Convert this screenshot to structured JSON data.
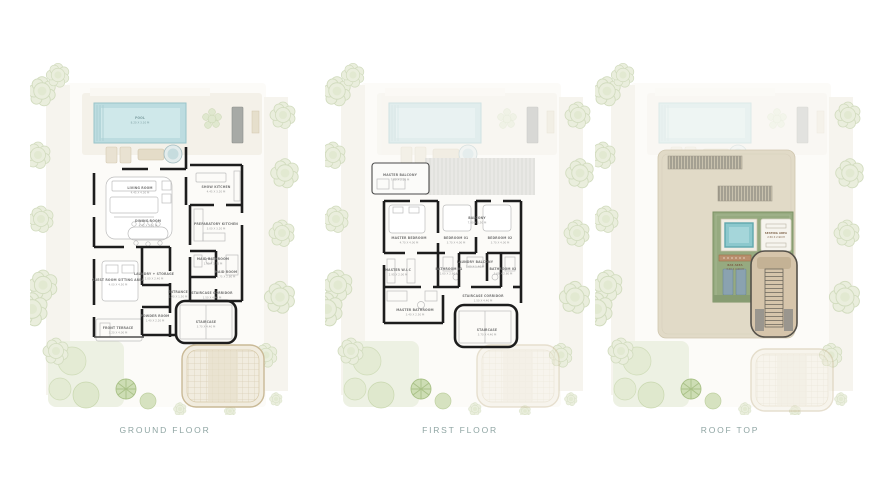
{
  "colors": {
    "caption_text": "#8FA5A3",
    "pool_water": "#BCDCE0",
    "walls": "#1D1D1D",
    "landscape_green": "#E9EEDA",
    "roof_slab_beige": "#E1DAC7",
    "roof_terrace_green": "#96AA80",
    "jacuzzi_blue": "#8CC8CD"
  },
  "plans": [
    {
      "caption": "GROUND FLOOR",
      "rooms": [
        {
          "n": "POOL",
          "d": "8.20 X 3.10 M"
        },
        {
          "n": "LIVING ROOM",
          "d": "4.45 X 4.30 M"
        },
        {
          "n": "SHOW KITCHEN",
          "d": "4.45 X 3.20 M"
        },
        {
          "n": "DINING ROOM",
          "d": "4.45 X 3.60 M"
        },
        {
          "n": "PREPARATORY KITCHEN",
          "d": "3.00 X 3.20 M"
        },
        {
          "n": "MAID BATHROOM",
          "d": "1.60 X 1.75 M"
        },
        {
          "n": "MAID ROOM",
          "d": "1.75 X 2.80 M"
        },
        {
          "n": "GUEST ROOM SITTING AREA",
          "d": "4.00 X 4.50 M"
        },
        {
          "n": "LAUNDRY + STORAGE",
          "d": "2.00 X 2.40 M"
        },
        {
          "n": "ENTRANCE",
          "d": "2.40 X 1.50 M"
        },
        {
          "n": "STAIRCASE CORRIDOR",
          "d": "1.50 X 4.40 M"
        },
        {
          "n": "POWDER ROOM",
          "d": "1.40 X 2.20 M"
        },
        {
          "n": "FRONT TERRACE",
          "d": "3.20 X 4.00 M"
        },
        {
          "n": "STAIRCASE",
          "d": "3.70 X 4.40 M"
        }
      ]
    },
    {
      "caption": "FIRST FLOOR",
      "rooms": [
        {
          "n": "MASTER BALCONY",
          "d": "7.00 X 2.20 M"
        },
        {
          "n": "BALCONY",
          "d": "7.00 X 1.50 M"
        },
        {
          "n": "MASTER BEDROOM",
          "d": "4.70 X 4.00 M"
        },
        {
          "n": "BEDROOM 01",
          "d": "3.70 X 4.00 M"
        },
        {
          "n": "BEDROOM 02",
          "d": "3.70 X 4.00 M"
        },
        {
          "n": "MASTER W.I.C",
          "d": "2.95 X 2.00 M"
        },
        {
          "n": "BATHROOM 01",
          "d": "1.60 X 2.60 M"
        },
        {
          "n": "LAUNDRY BALCONY",
          "d": "1.60 X 1.40 M"
        },
        {
          "n": "BATHROOM 02",
          "d": "1.60 X 2.60 M"
        },
        {
          "n": "STAIRCASE CORRIDOR",
          "d": "1.50 X 4.40 M"
        },
        {
          "n": "MASTER BATHROOM",
          "d": "3.40 X 2.50 M"
        },
        {
          "n": "STAIRCASE",
          "d": "3.70 X 4.40 M"
        }
      ]
    },
    {
      "caption": "ROOF TOP",
      "rooms": [
        {
          "n": "SEATING AREA",
          "d": "2.50 X 2.90 M"
        },
        {
          "n": "BAR AREA",
          "d": "3.40 X 0.60 M"
        }
      ]
    }
  ]
}
